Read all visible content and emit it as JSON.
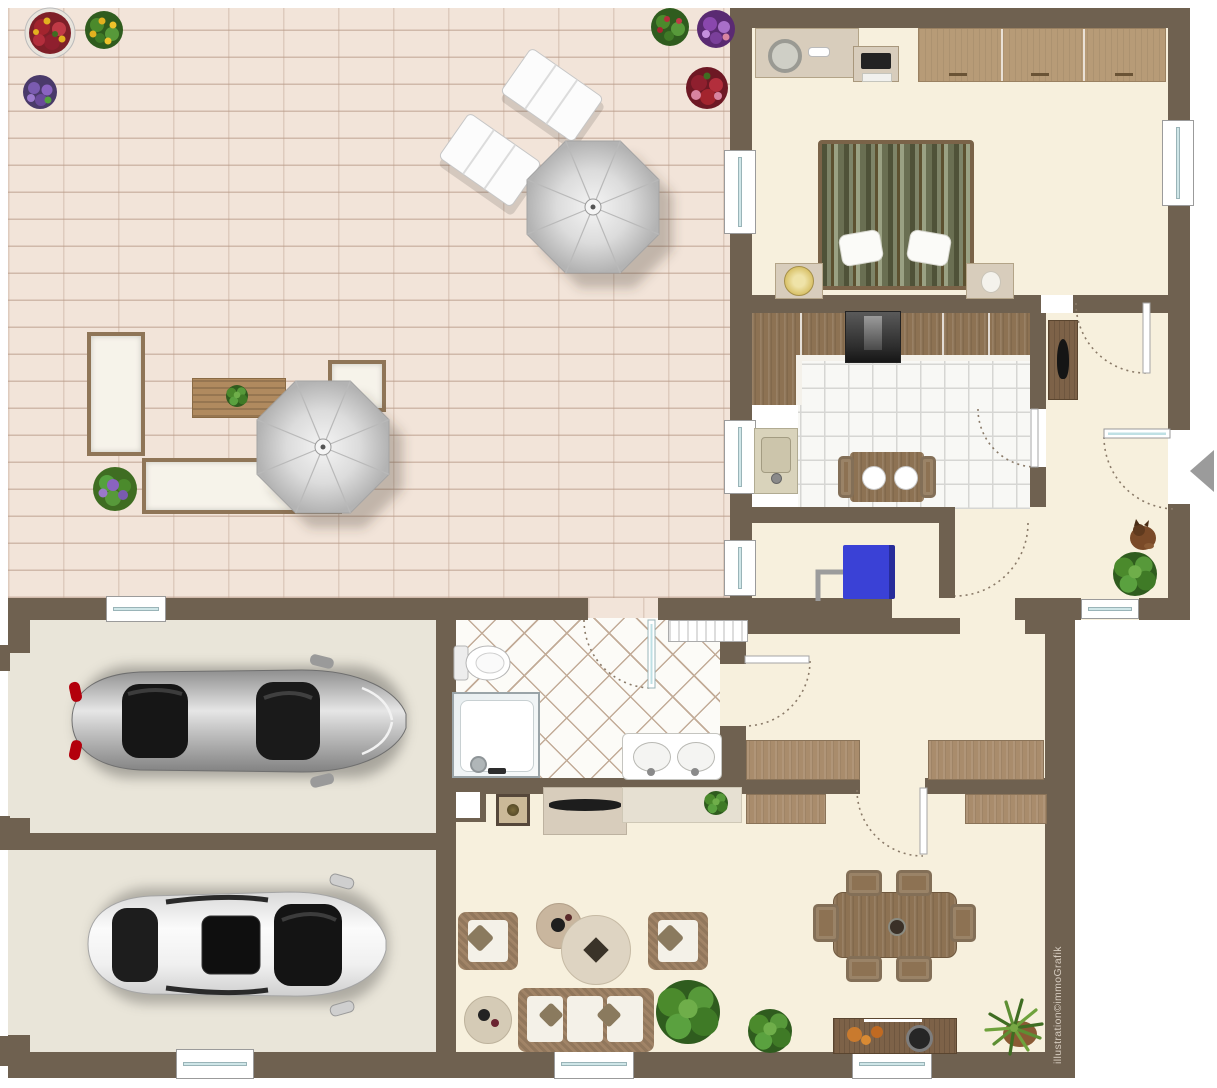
{
  "watermark": {
    "text": "illustration©immoGrafik"
  },
  "palette": {
    "wall": "#6f6150",
    "floor_cream": "#f7f0dd",
    "floor_garage": "#e9e5d9",
    "patio_brick": "#f2e4d9",
    "kitchen_tile": "#f8f8f5",
    "bath_tile": "#fcfbf7",
    "window_glass": "#cfe6e8",
    "wood_dark": "#8d7253",
    "wood_mid": "#b79b77",
    "wood_light": "#d8cdbc",
    "wicker": "#a18467",
    "blue_cabinet": "#3a41d6",
    "plant_green": "#4a8a2c",
    "umbrella_gray": "#cccccc",
    "car_silver": "#bcbcbc",
    "car_white": "#f2f2f2",
    "entrance_arrow": "#9b9b9b"
  },
  "icons": {
    "entrance_arrow": "left-pointing triangle marking the main entrance door",
    "door_swing": "dashed quarter-circle arc",
    "window": "white frame with light-blue glass line"
  },
  "inventory": [
    "patio-with-brick-paving",
    "sun-umbrella",
    "sun-lounger",
    "garden-bench-group",
    "flower-pots",
    "bedroom-double-bed",
    "wardrobe",
    "dresser",
    "tv-stand",
    "kitchen-l-counter",
    "stove",
    "kitchen-sink",
    "kitchen-table",
    "tall-cabinet",
    "blue-cabinet",
    "entry-hall-plant",
    "cat",
    "bathroom-toilet",
    "shower",
    "double-sink-vanity",
    "radiator-shelf",
    "garage-silver-car",
    "garage-white-car",
    "desks-back-to-back",
    "sideboards",
    "tv-lowboard",
    "armchairs",
    "sofa",
    "coffee-tables",
    "dining-table-six-chairs",
    "dining-sideboard",
    "yucca-plant"
  ]
}
